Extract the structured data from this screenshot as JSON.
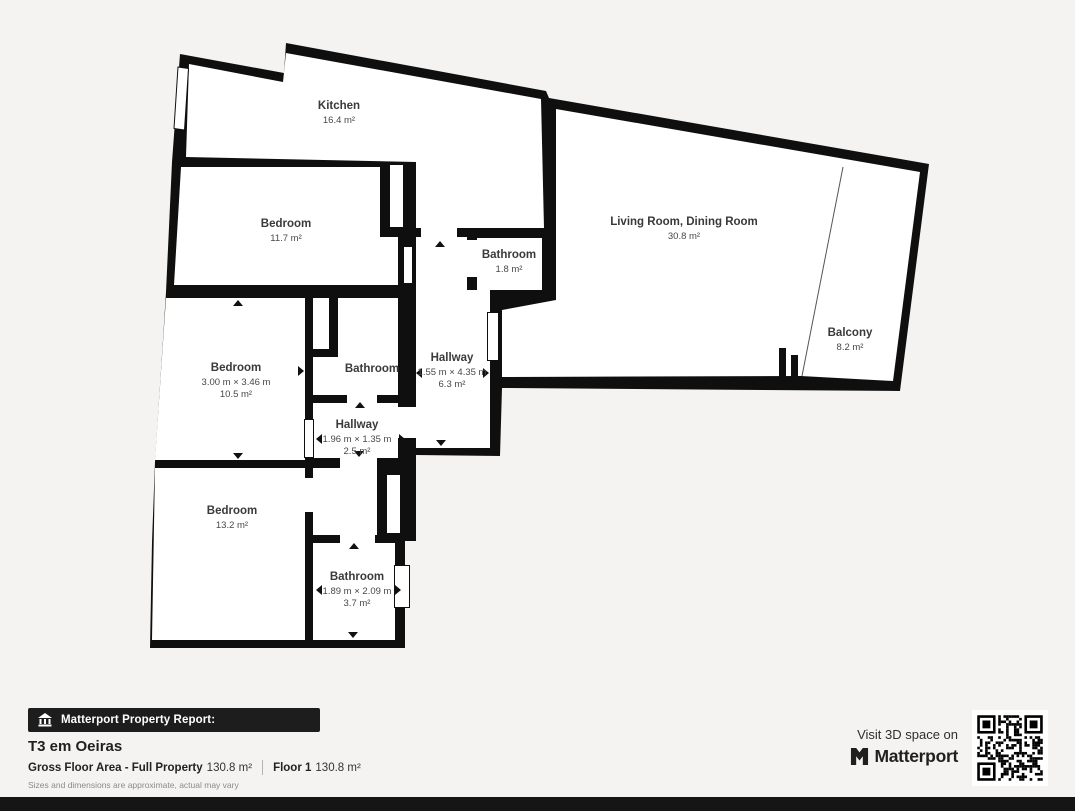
{
  "plan": {
    "rooms": {
      "kitchen": {
        "name": "Kitchen",
        "area": "16.4 m²"
      },
      "bedroom1": {
        "name": "Bedroom",
        "area": "11.7 m²"
      },
      "bathroom_small": {
        "name": "Bathroom",
        "area": "1.8 m²"
      },
      "living": {
        "name": "Living Room, Dining Room",
        "area": "30.8 m²"
      },
      "balcony": {
        "name": "Balcony",
        "area": "8.2 m²"
      },
      "bedroom2": {
        "name": "Bedroom",
        "dims": "3.00 m × 3.46 m",
        "area": "10.5 m²"
      },
      "bathroom_mid": {
        "name": "Bathroom"
      },
      "hallway_main": {
        "name": "Hallway",
        "dims": "1.55 m × 4.35 m",
        "area": "6.3 m²"
      },
      "hallway_small": {
        "name": "Hallway",
        "dims": "1.96 m × 1.35 m",
        "area": "2.5 m²"
      },
      "bedroom3": {
        "name": "Bedroom",
        "area": "13.2 m²"
      },
      "bathroom_big": {
        "name": "Bathroom",
        "dims": "1.89 m × 2.09 m",
        "area": "3.7 m²"
      }
    },
    "colors": {
      "wall": "#0f0f0f",
      "floor": "#ffffff",
      "background": "#f4f3f1",
      "label_text": "#3d3d3d"
    }
  },
  "footer": {
    "badge_label": "Matterport Property Report:",
    "badge_icon": "museum-building-icon",
    "title": "T3 em Oeiras",
    "gfa_label": "Gross Floor Area - Full Property",
    "gfa_value": "130.8 m²",
    "floor_label": "Floor 1",
    "floor_value": "130.8 m²",
    "disclaimer": "Sizes and dimensions are approximate, actual may vary"
  },
  "cta": {
    "line1": "Visit 3D space on",
    "brand": "Matterport",
    "brand_icon": "matterport-logo-icon",
    "qr_icon": "qr-code"
  }
}
